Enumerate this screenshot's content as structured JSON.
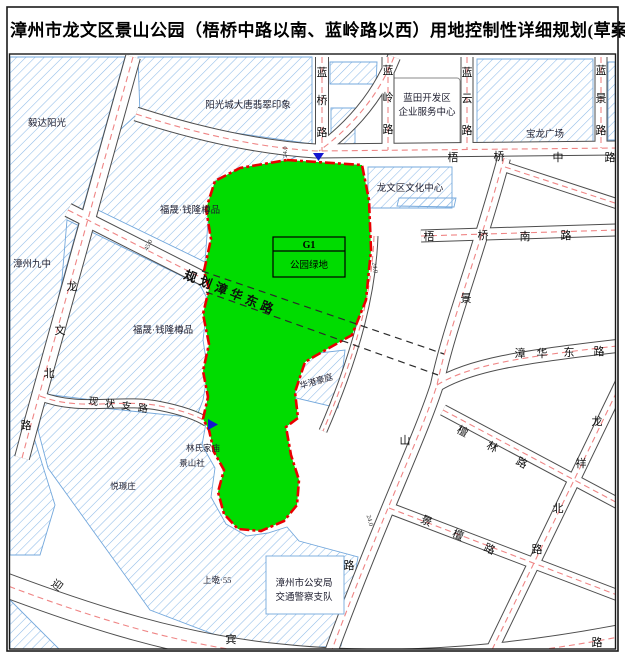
{
  "title": "漳州市龙文区景山公园（梧桥中路以南、蓝岭路以西）用地控制性详细规划(草案)",
  "park": {
    "code": "G1",
    "use": "公园绿地"
  },
  "roads": {
    "lanqiao": "蓝桥路",
    "lanling": "蓝岭路",
    "lanyun": "蓝云路",
    "lanjing": "蓝景路",
    "wuqiao_mid": "梧桥中路",
    "wuqiao_south": "梧桥南路",
    "zhanghua_east": "漳华东路",
    "planned_zhanghua": "规划漳华东路",
    "existing_branch": "现状支路",
    "longwen_north": "龙文北路",
    "jingshan": "景山路",
    "tanlin": "檀林路",
    "longxiang_north": "龙祥北路",
    "jingtan": "景檀路",
    "yingbin": "迎宾路"
  },
  "places": {
    "yida": "毅达阳光",
    "sunshine": "阳光城大唐翡翠印象",
    "lantian1": "蓝田开发区",
    "lantian2": "企业服务中心",
    "baolong": "宝龙广场",
    "culture": "龙文区文化中心",
    "fusheng_a": "福晟·钱隆樽品",
    "fusheng_b": "福晟·钱隆樽品",
    "school": "漳州九中",
    "huagang": "华港豪庭",
    "lin_temple": "林氏家庙",
    "jingshan_she": "景山社",
    "yuejing": "悦璟庄",
    "shangqian": "上墘·55",
    "police1": "漳州市公安局",
    "police2": "交通警察支队"
  },
  "annotations": {
    "w1": "45.0",
    "w2": "24.0",
    "w3": "24.0",
    "w4": "24.0"
  },
  "icons": {
    "entrance_top": "blue-triangle-down-icon",
    "entrance_west": "blue-triangle-right-icon"
  },
  "colors": {
    "park_green": "#00dc00",
    "boundary_red": "#e80000",
    "hatch_blue": "#8fbbe8",
    "centerline_red": "#ef8585"
  }
}
